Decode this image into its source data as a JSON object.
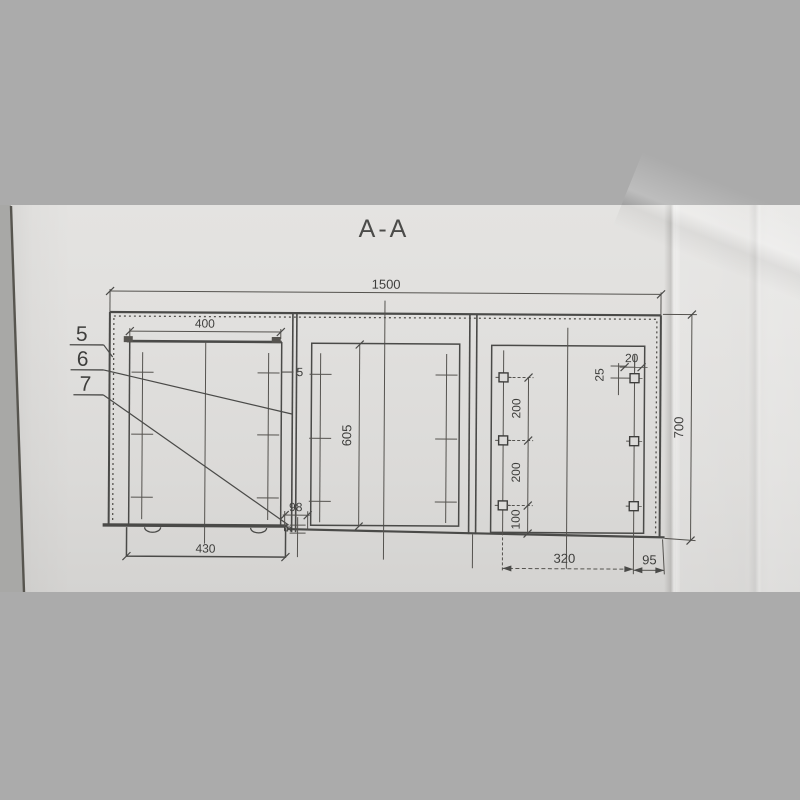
{
  "photo": {
    "backdrop_color": "#ababab",
    "paper_color": "#dedddb",
    "line_color": "#4a4a48",
    "text_color": "#3e3e3c"
  },
  "drawing": {
    "section_title": "A-A",
    "part_labels": {
      "items": [
        "5",
        "6",
        "7"
      ]
    },
    "dimensions": {
      "overall_width": "1500",
      "overall_height": "700",
      "left_opening_width": "400",
      "left_base_width": "430",
      "panel_gap": "5",
      "middle_inner_height": "605",
      "bottom_offset": "98",
      "bottom_gap": "5",
      "hole_pitch_upper": "200",
      "hole_pitch_lower": "200",
      "hole_bottom_offset": "100",
      "hole_top_offset": "25",
      "hole_edge_offset": "20",
      "base_plate_width": "320",
      "base_edge_offset": "95"
    }
  }
}
